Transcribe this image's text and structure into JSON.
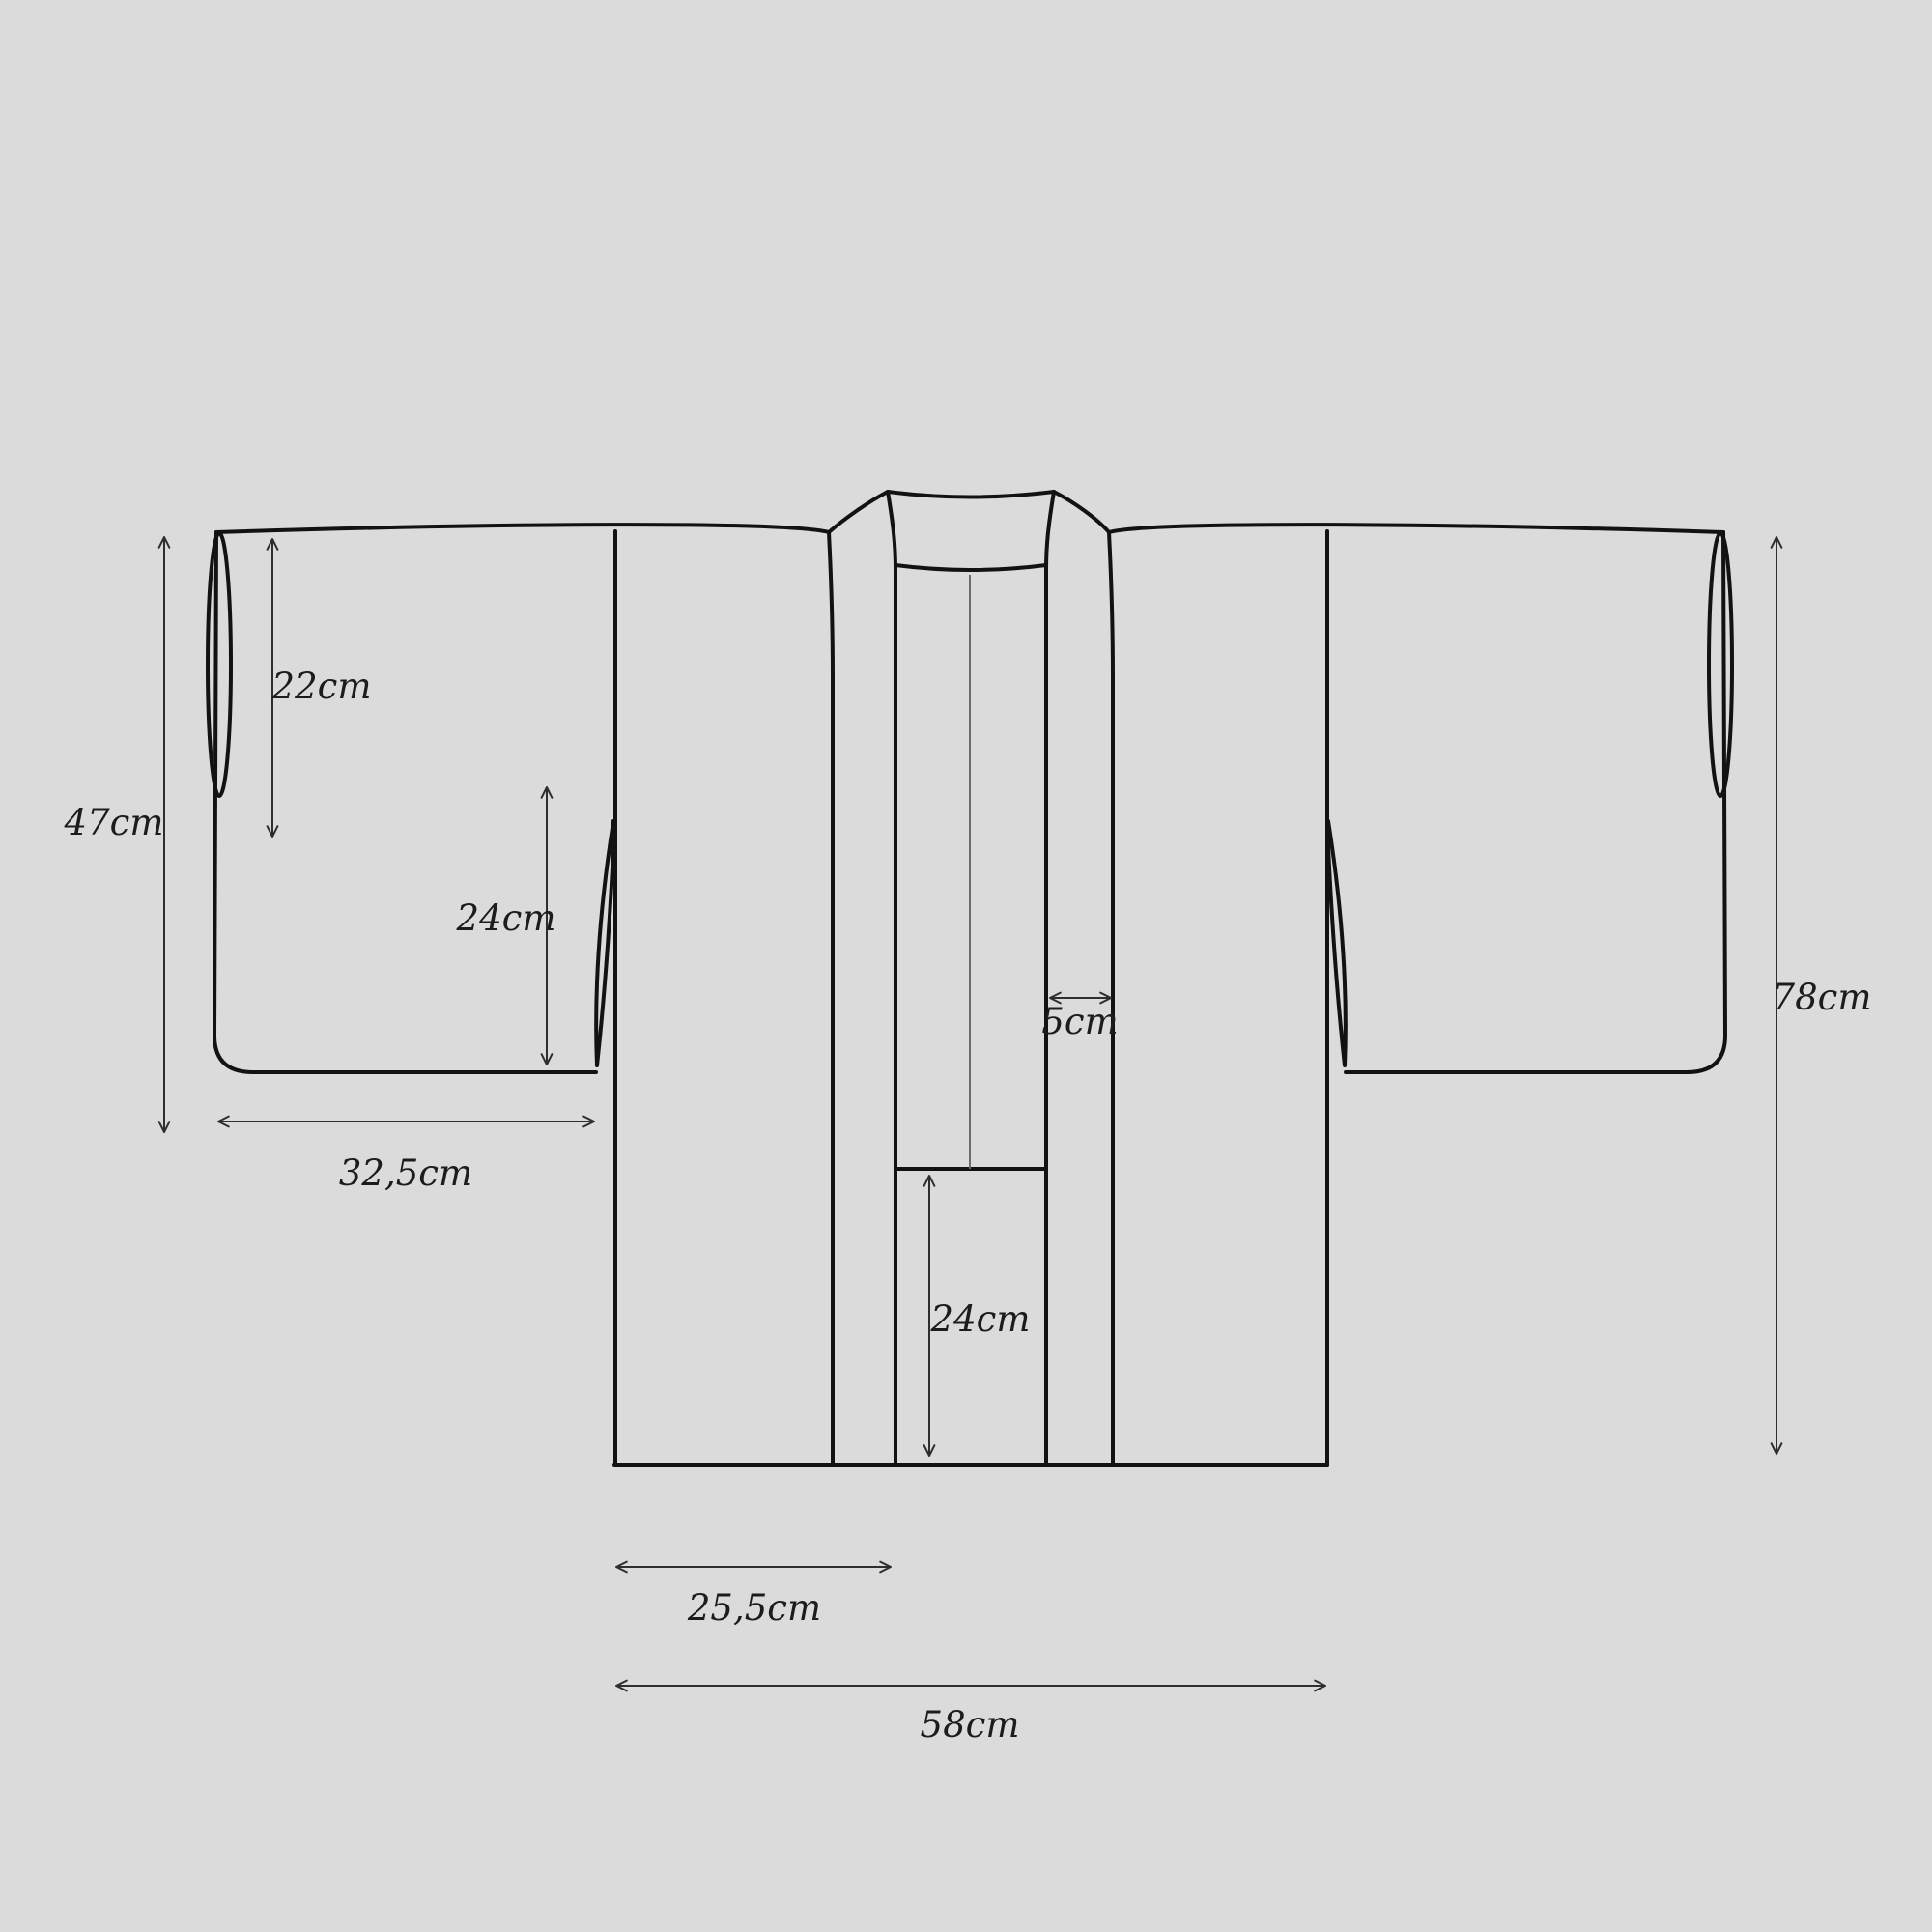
{
  "diagram": {
    "subject": "kimono-jacket-technical-flat",
    "measurements": {
      "sleeve_length": "47cm",
      "sleeve_opening": "22cm",
      "armhole_depth": "24cm",
      "sleeve_width": "32,5cm",
      "collar_width": "5cm",
      "back_panel_height": "24cm",
      "front_panel_width": "25,5cm",
      "hem_width": "58cm",
      "body_length": "78cm"
    },
    "colors": {
      "background": "#dbdbdb",
      "outline": "#121212",
      "dimension_line": "#2e2e2e",
      "center_seam": "#6b6b6b",
      "label_text": "#1c1c1c"
    }
  }
}
